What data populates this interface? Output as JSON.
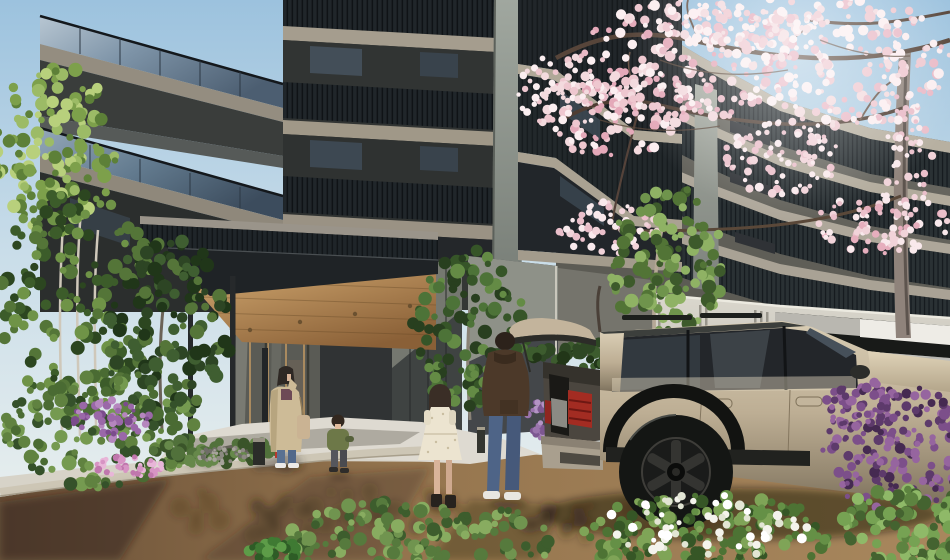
{
  "meta": {
    "type": "architectural-rendering",
    "description": "Daytime CG rendering of a modern condominium entrance: dark high-rise with glass balconies, wood-soffit entrance canopy, beige SUV with open tailgate in the driveway, residents walking, cherry blossoms and lush planting.",
    "width": 950,
    "height": 560
  },
  "palette": {
    "sky_top": "#9cc2de",
    "sky_horizon": "#eef2ef",
    "facade_dark": "#343735",
    "facade_shadow": "#2a2d2c",
    "slab_beige": "#a59d8e",
    "balcony_glass": "#7d93a7",
    "wing_wall": "#55544e",
    "wing_slab": "#b7b0a1",
    "railing_dark": "#20262a",
    "concrete_wall": "#cfccc2",
    "garage_door": "#b2b1ac",
    "canopy_fascia": "#1f2326",
    "canopy_wood": "#c9a069",
    "entrance_glass": "#5a5b55",
    "tile_wall": "#3f4342",
    "tile_wall_lit": "#757870",
    "path_light": "#d7d3c8",
    "path_apron": "#dedad1",
    "dirt": "#9c7b54",
    "dirt_shadow": "#5f472f",
    "car_body": "#c3b49c",
    "car_glass": "#23262a",
    "car_tire": "#141614",
    "taillight": "#a32c22",
    "bumper_gray": "#a99f8e",
    "blossom_pink": "#f3dade",
    "branch_brown": "#57453a",
    "trunk_gray": "#8f837b",
    "leaf_green": "#5d8038",
    "leaf_dark": "#35512a",
    "flower_purple": "#7c4f8a",
    "flower_pink": "#d794c4",
    "flower_white": "#f4f3ec",
    "coat_beige": "#cdbb97",
    "hoodie_brown": "#4c3929",
    "denim": "#4e6487",
    "dress_cream": "#ece4d0",
    "jacket_green": "#6d7848"
  },
  "scene": {
    "objects": [
      {
        "name": "apartment-tower",
        "label": "dark residential tower with glass balconies"
      },
      {
        "name": "apartment-wing",
        "label": "lower residential wing receding to the right"
      },
      {
        "name": "entrance-canopy",
        "label": "flat canopy with wood soffit on slim posts"
      },
      {
        "name": "entrance-doors",
        "label": "glazed entrance lobby"
      },
      {
        "name": "retaining-wall",
        "label": "ribbed precast concrete wall"
      },
      {
        "name": "garage",
        "label": "parking garage opening with gray door"
      },
      {
        "name": "cherry-blossom-tree",
        "label": "blooming cherry tree"
      },
      {
        "name": "suv",
        "label": "beige SUV with open tailgate"
      },
      {
        "name": "woman-on-phone",
        "label": "woman in beige coat on phone"
      },
      {
        "name": "toddler",
        "label": "toddler in green jacket"
      },
      {
        "name": "girl",
        "label": "girl in cream dress"
      },
      {
        "name": "man",
        "label": "man in brown hoodie and jeans"
      },
      {
        "name": "driveway",
        "label": "earth-toned driveway"
      },
      {
        "name": "garden",
        "label": "planted garden beds with flowers"
      }
    ]
  },
  "vegetation": {
    "back": [
      {
        "name": "left-birch-top",
        "x": 55,
        "y": 150,
        "rx": 62,
        "ry": 85,
        "n": 130,
        "colors": [
          "#9cbb66",
          "#7da04b",
          "#5d8038",
          "#b8d07c"
        ]
      },
      {
        "name": "left-birch-lower",
        "x": 75,
        "y": 300,
        "rx": 80,
        "ry": 110,
        "n": 150,
        "colors": [
          "#547538",
          "#3c5c2a",
          "#6f9347",
          "#2c4620"
        ]
      },
      {
        "name": "entry-left-tree",
        "x": 168,
        "y": 330,
        "rx": 62,
        "ry": 95,
        "n": 140,
        "colors": [
          "#3f5e31",
          "#2d4524",
          "#557539",
          "#203619"
        ]
      },
      {
        "name": "entry-right-tree",
        "x": 470,
        "y": 330,
        "rx": 58,
        "ry": 80,
        "n": 120,
        "colors": [
          "#4d7338",
          "#365528",
          "#648b45",
          "#283f1f"
        ]
      },
      {
        "name": "wall-tree",
        "x": 668,
        "y": 262,
        "rx": 58,
        "ry": 78,
        "n": 120,
        "colors": [
          "#6f944c",
          "#527436",
          "#8fb264",
          "#3d5a2b"
        ]
      },
      {
        "name": "hedge-line",
        "x": 600,
        "y": 356,
        "rx": 70,
        "ry": 14,
        "n": 60,
        "colors": [
          "#2e4724",
          "#223618",
          "#3d5c2e"
        ]
      },
      {
        "name": "lilac-behind-car",
        "x": 543,
        "y": 412,
        "rx": 16,
        "ry": 28,
        "n": 40,
        "rmin": 2,
        "rmax": 4,
        "colors": [
          "#9a74ac",
          "#7d5791",
          "#b393c4"
        ]
      },
      {
        "name": "garden-bush",
        "x": 100,
        "y": 430,
        "rx": 100,
        "ry": 58,
        "n": 170,
        "colors": [
          "#4a6b33",
          "#35512a",
          "#608240",
          "#759a50"
        ]
      },
      {
        "name": "garden-purple-flowers",
        "x": 110,
        "y": 420,
        "rx": 40,
        "ry": 20,
        "n": 50,
        "rmin": 2,
        "rmax": 4.5,
        "colors": [
          "#9a68a8",
          "#7b4c8c",
          "#b586be"
        ]
      },
      {
        "name": "garden-pink-flowers",
        "x": 130,
        "y": 467,
        "rx": 34,
        "ry": 12,
        "n": 45,
        "rmin": 2,
        "rmax": 4,
        "colors": [
          "#d794c4",
          "#c077ad",
          "#e8b6d8"
        ]
      },
      {
        "name": "garden-low-plants",
        "x": 215,
        "y": 452,
        "rx": 62,
        "ry": 14,
        "n": 50,
        "colors": [
          "#51713b",
          "#3a5429",
          "#66884a"
        ]
      },
      {
        "name": "gravel-bed",
        "x": 224,
        "y": 455,
        "rx": 26,
        "ry": 8,
        "n": 45,
        "rmin": 1.2,
        "rmax": 2.6,
        "colors": [
          "#8d8a82",
          "#6f6d67",
          "#a6a39b"
        ]
      }
    ],
    "blossom": [
      {
        "name": "blossom-main",
        "x": 690,
        "y": 62,
        "rx": 112,
        "ry": 62,
        "n": 215,
        "rmin": 2.2,
        "rmax": 5.5,
        "colors": [
          "#f3dade",
          "#eec7cf",
          "#fbeef0",
          "#e9b9c6",
          "#e4a9b9"
        ]
      },
      {
        "name": "blossom-right",
        "x": 852,
        "y": 64,
        "rx": 100,
        "ry": 66,
        "n": 190,
        "rmin": 2.2,
        "rmax": 5.5,
        "colors": [
          "#f3dade",
          "#eec7cf",
          "#fbeef0",
          "#e9b9c6"
        ]
      },
      {
        "name": "blossom-mid-left",
        "x": 615,
        "y": 112,
        "rx": 72,
        "ry": 46,
        "n": 110,
        "rmin": 2,
        "rmax": 5,
        "colors": [
          "#f3dade",
          "#eec7cf",
          "#fbeef0",
          "#e4a9b9"
        ]
      },
      {
        "name": "blossom-center-low",
        "x": 782,
        "y": 158,
        "rx": 58,
        "ry": 38,
        "n": 80,
        "rmin": 2,
        "rmax": 4.5,
        "colors": [
          "#f1d3d9",
          "#eabfca",
          "#f9e9ec"
        ]
      },
      {
        "name": "blossom-right-low",
        "x": 882,
        "y": 224,
        "rx": 66,
        "ry": 30,
        "n": 75,
        "rmin": 2,
        "rmax": 4.5,
        "colors": [
          "#f1d3d9",
          "#eabfca",
          "#f9e9ec",
          "#e6aebd"
        ]
      },
      {
        "name": "blossom-left-low",
        "x": 610,
        "y": 228,
        "rx": 52,
        "ry": 26,
        "n": 55,
        "rmin": 2,
        "rmax": 4.2,
        "colors": [
          "#f1d3d9",
          "#eabfca",
          "#f9e9ec"
        ]
      },
      {
        "name": "blossom-top",
        "x": 742,
        "y": 22,
        "rx": 85,
        "ry": 26,
        "n": 85,
        "rmin": 2,
        "rmax": 5,
        "colors": [
          "#f3dade",
          "#eec7cf",
          "#fbeef0"
        ]
      },
      {
        "name": "blossom-far-left",
        "x": 560,
        "y": 92,
        "rx": 42,
        "ry": 38,
        "n": 55,
        "rmin": 2,
        "rmax": 4.5,
        "colors": [
          "#f3dade",
          "#eec7cf",
          "#fbeef0"
        ]
      },
      {
        "name": "blossom-trunk-side",
        "x": 905,
        "y": 162,
        "rx": 28,
        "ry": 58,
        "n": 45,
        "rmin": 2,
        "rmax": 4.2,
        "colors": [
          "#f1d3d9",
          "#eabfca",
          "#f9e9ec"
        ]
      }
    ],
    "front": [
      {
        "name": "center-bush",
        "x": 420,
        "y": 540,
        "rx": 135,
        "ry": 42,
        "n": 150,
        "colors": [
          "#567a3d",
          "#3d5d2d",
          "#70944f",
          "#88ac60"
        ]
      },
      {
        "name": "center-leaf-clump",
        "x": 272,
        "y": 553,
        "rx": 30,
        "ry": 12,
        "n": 30,
        "rmin": 3,
        "rmax": 6,
        "colors": [
          "#3f7a33",
          "#5d9c48",
          "#2e5c26"
        ]
      },
      {
        "name": "white-flower-bush",
        "x": 705,
        "y": 535,
        "rx": 125,
        "ry": 42,
        "n": 150,
        "colors": [
          "#4d7334",
          "#365626",
          "#659046",
          "#7fa457"
        ]
      },
      {
        "name": "white-flowers",
        "x": 700,
        "y": 528,
        "rx": 108,
        "ry": 34,
        "n": 60,
        "rmin": 2.5,
        "rmax": 5,
        "colors": [
          "#f4f3ec",
          "#ffffff",
          "#e2e5d4"
        ]
      },
      {
        "name": "purple-azalea",
        "x": 893,
        "y": 448,
        "rx": 72,
        "ry": 68,
        "n": 165,
        "rmin": 2.5,
        "rmax": 5.5,
        "colors": [
          "#7c4f8a",
          "#5d3a6b",
          "#96659f",
          "#452a51"
        ]
      },
      {
        "name": "purple-azalea-upper",
        "x": 862,
        "y": 406,
        "rx": 40,
        "ry": 24,
        "n": 55,
        "rmin": 2.5,
        "rmax": 5,
        "colors": [
          "#7c4f8a",
          "#5d3a6b",
          "#96659f"
        ]
      },
      {
        "name": "right-corner-foliage",
        "x": 908,
        "y": 528,
        "rx": 70,
        "ry": 42,
        "n": 120,
        "colors": [
          "#5d8340",
          "#446330",
          "#76a253",
          "#8fb968"
        ]
      }
    ],
    "dapple": [
      {
        "name": "ground-dapple-left",
        "x": 310,
        "y": 512,
        "rx": 170,
        "ry": 26,
        "n": 40,
        "rmin": 5,
        "rmax": 11,
        "opacity": 0.22,
        "colors": [
          "#2e2115"
        ]
      },
      {
        "name": "ground-dapple-right",
        "x": 620,
        "y": 522,
        "rx": 110,
        "ry": 20,
        "n": 26,
        "rmin": 5,
        "rmax": 10,
        "opacity": 0.2,
        "colors": [
          "#271c11"
        ]
      },
      {
        "name": "walkway-shadow",
        "x": 250,
        "y": 462,
        "rx": 70,
        "ry": 10,
        "n": 22,
        "rmin": 3,
        "rmax": 7,
        "opacity": 0.25,
        "colors": [
          "#33302a"
        ]
      }
    ]
  }
}
